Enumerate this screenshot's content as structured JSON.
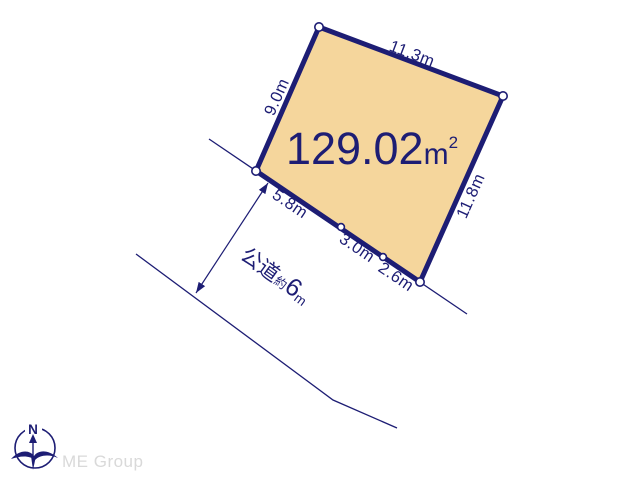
{
  "diagram_title": "land-plot-survey",
  "colors": {
    "line_navy": "#1d1d74",
    "plot_fill": "#f5d69c",
    "logo_gray": "#d9d9d9",
    "background": "#ffffff"
  },
  "plot": {
    "area_value": "129.02",
    "area_unit_base": "m",
    "area_unit_exponent": "2",
    "edge_labels": {
      "top": "11.3m",
      "left": "9.0m",
      "right": "11.8m",
      "bottom_segments": [
        "5.8m",
        "3.0m",
        "2.6m"
      ]
    }
  },
  "road": {
    "type_label": "公道",
    "approx_label": "約",
    "width_value": "6",
    "width_unit": "m"
  },
  "compass": {
    "north_label": "N"
  },
  "branding": {
    "logo_text": "ME Group"
  }
}
